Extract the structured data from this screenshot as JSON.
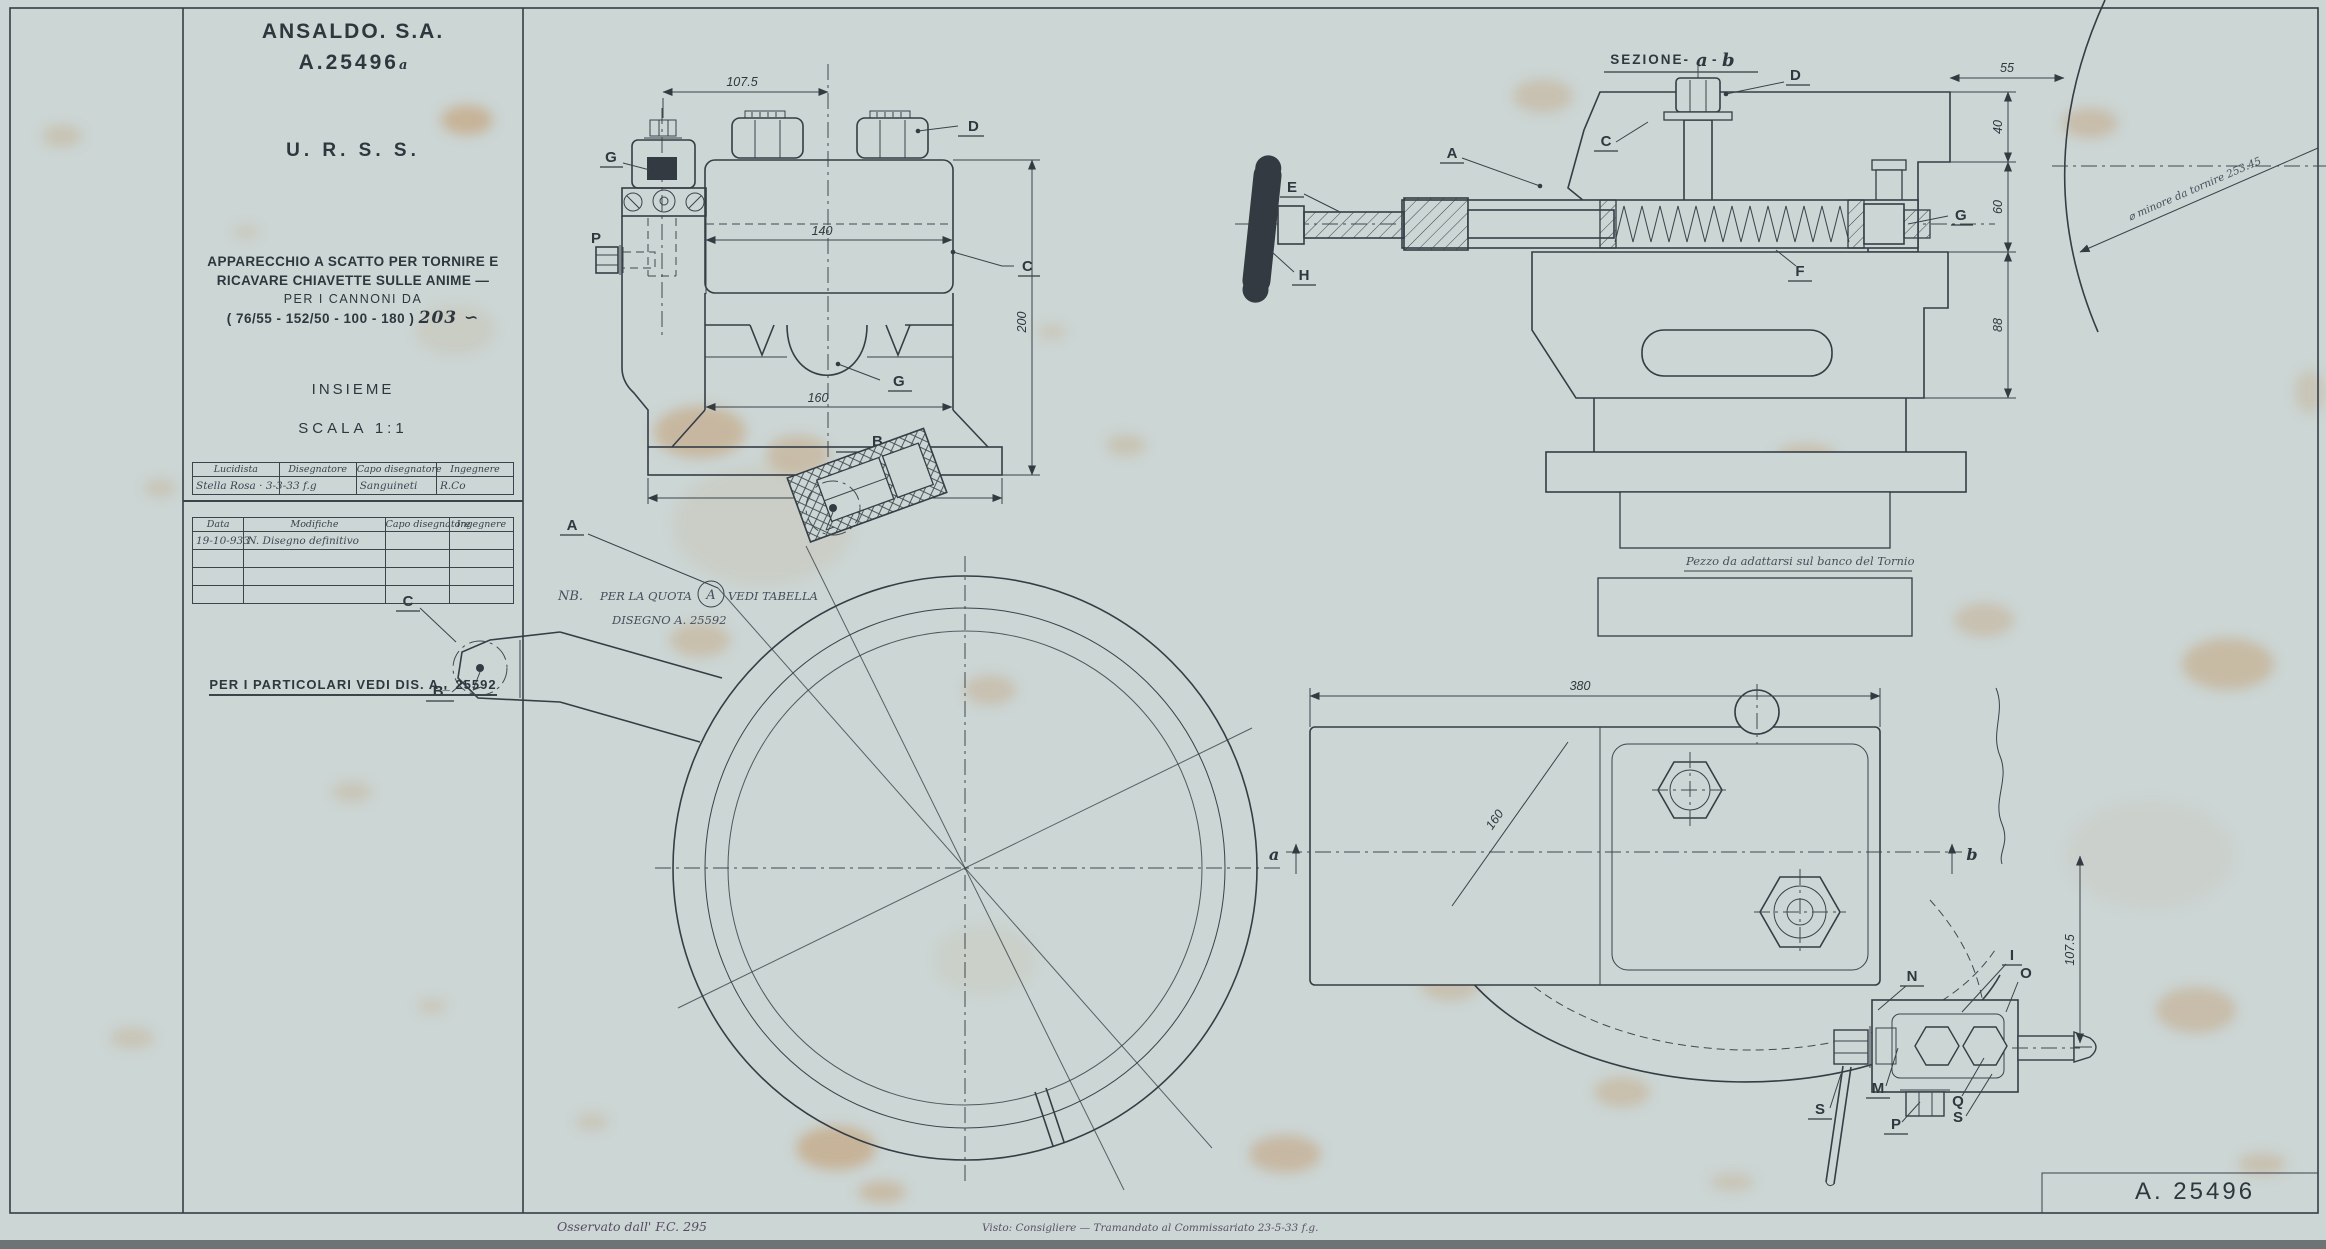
{
  "doc": {
    "company": "ANSALDO. S.A.",
    "number": "A.25496",
    "number_suffix": "a",
    "country": "U. R. S. S.",
    "desc1": "APPARECCHIO A SCATTO PER TORNIRE E",
    "desc2": "RICAVARE CHIAVETTE SULLE ANIME —",
    "desc3": "PER I CANNONI DA",
    "desc4a": "( 76/55 -  152/50 - 100  -  180 )",
    "desc4b": "203 ∽",
    "insieme": "INSIEME",
    "scala": "SCALA 1:1",
    "note_details": "PER I PARTICOLARI VEDI DIS.  A _ 25592"
  },
  "sig": {
    "h1": "Lucidista",
    "h2": "Disegnatore",
    "h3": "Capo disegnatore",
    "h4": "Ingegnere",
    "r1": "Stella Rosa · 3-3-33 f.g",
    "r2": "",
    "r3": "Sanguineti",
    "r4": "R.Co"
  },
  "rev": {
    "h1": "Data",
    "h2": "Modifiche",
    "h3": "Capo disegnatore",
    "h4": "Ingegnere",
    "r1c1": "19-10-933",
    "r1c2": "N. Disegno definitivo"
  },
  "front": {
    "dim_top": "107.5",
    "dim_upper": "140",
    "dim_lower": "160",
    "dim_base": "220",
    "dim_height": "200",
    "lbl_g1": "G",
    "lbl_d": "D",
    "lbl_c": "C",
    "lbl_g2": "G",
    "lbl_b": "B",
    "lbl_p": "P"
  },
  "section": {
    "title_pre": "SEZIONE-",
    "title_a": "a",
    "title_dash": "-",
    "title_b": "b",
    "lbl_a": "A",
    "lbl_c": "C",
    "lbl_d": "D",
    "lbl_e": "E",
    "lbl_f": "F",
    "lbl_g": "G",
    "lbl_h": "H",
    "dim_55": "55",
    "dim_40": "40",
    "dim_60": "60",
    "dim_88": "88",
    "note": "Pezzo da adattarsi sul banco del Tornio"
  },
  "ring": {
    "note1a": "NB.",
    "note1b": "PER LA QUOTA",
    "note1c": "A",
    "note1d": "VEDI TABELLA",
    "note2": "DISEGNO  A. 25592",
    "lbl_a": "A",
    "lbl_b": "B'",
    "lbl_c": "C"
  },
  "plan": {
    "dim_width": "380",
    "dim_diag": "160",
    "dim_right": "107.5",
    "lbl_a": "a",
    "lbl_b": "b",
    "lbl_i": "I",
    "lbl_o": "O",
    "lbl_n": "N",
    "lbl_m": "M",
    "lbl_p": "P",
    "lbl_q": "Q",
    "lbl_s1": "S",
    "lbl_s2": "S"
  },
  "corner": {
    "note": "⌀ minore da tornire 253.45"
  },
  "footer": {
    "number": "A. 25496",
    "hw_left": "Osservato dall' F.C. 295",
    "hw_right": "Visto: Consigliere — Tramandato al Commissariato 23-5-33 f.g."
  },
  "colors": {
    "paper": "#ccd6d5",
    "ink": "#333b42",
    "stain": "#c08a4e"
  }
}
